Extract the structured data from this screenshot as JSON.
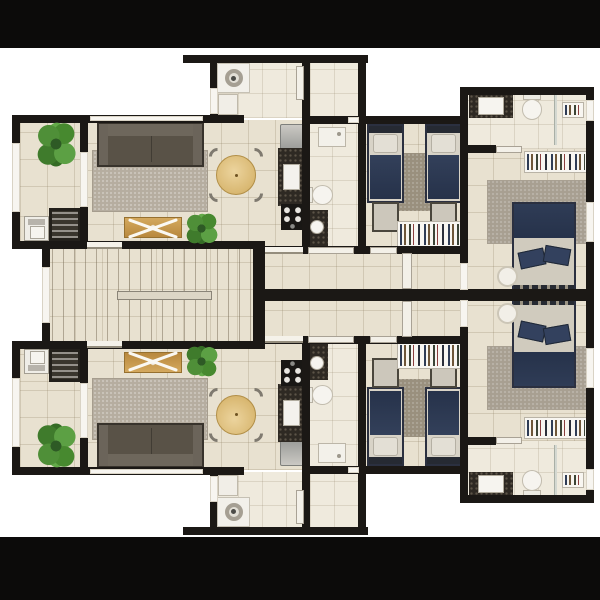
{
  "title": "apartment-floor-plan",
  "palette": {
    "background": "#ffffff",
    "letterbox": "#0c0b0a",
    "wall": "#1b1815",
    "floor_beige": "#e8e1d0",
    "floor_light": "#efeadd",
    "rug_gray": "#b6ada0",
    "sofa_gray": "#595247",
    "wood": "#c89a55",
    "table_wood": "#e0c084",
    "plant_green": "#4f8f38",
    "bed_navy": "#2c3950",
    "bedding_light": "#d8d3c7",
    "granite": "#2e2923",
    "fixture_white": "#f6f4ef"
  },
  "scene": {
    "canvas": {
      "w": 600,
      "h": 600
    },
    "mirror_axis_y": 295,
    "bars": [
      {
        "r": [
          0,
          0,
          600,
          48
        ]
      },
      {
        "r": [
          0,
          537,
          600,
          63
        ]
      }
    ],
    "floors": [
      {
        "r": [
          20,
          118,
          62,
          96
        ],
        "v": "b",
        "m": 1,
        "n": "balcony-floor"
      },
      {
        "r": [
          20,
          208,
          62,
          36
        ],
        "v": "b",
        "m": 1,
        "n": "laundry-floor"
      },
      {
        "r": [
          86,
          120,
          220,
          132
        ],
        "v": "b",
        "m": 1,
        "n": "living-dining-floor"
      },
      {
        "r": [
          214,
          60,
          152,
          58
        ],
        "v": "l",
        "m": 1,
        "n": "service-area-floor"
      },
      {
        "r": [
          308,
          121,
          52,
          132
        ],
        "v": "l",
        "m": 1,
        "n": "bathroom-floor"
      },
      {
        "r": [
          364,
          121,
          100,
          132
        ],
        "v": "b",
        "m": 1,
        "n": "twin-bedroom-floor"
      },
      {
        "r": [
          255,
          252,
          213,
          42
        ],
        "v": "b",
        "m": 1,
        "n": "corridor-floor"
      },
      {
        "r": [
          466,
          93,
          122,
          56
        ],
        "v": "l",
        "m": 1,
        "n": "ensuite-bathroom-floor"
      },
      {
        "r": [
          466,
          149,
          122,
          145
        ],
        "v": "b",
        "m": 1,
        "n": "master-bedroom-floor"
      },
      {
        "r": [
          48,
          246,
          207,
          98
        ],
        "v": "b",
        "m": 0,
        "n": "stair-hall-floor"
      }
    ],
    "walls": [
      {
        "r": [
          183,
          55,
          185,
          8
        ],
        "m": 1
      },
      {
        "r": [
          210,
          62,
          8,
          54
        ],
        "m": 1
      },
      {
        "r": [
          12,
          115,
          203,
          8
        ],
        "m": 1
      },
      {
        "r": [
          208,
          115,
          36,
          8
        ],
        "m": 1
      },
      {
        "r": [
          302,
          116,
          62,
          8
        ],
        "m": 1
      },
      {
        "r": [
          302,
          62,
          8,
          191
        ],
        "m": 1
      },
      {
        "r": [
          358,
          57,
          8,
          196
        ],
        "m": 1
      },
      {
        "r": [
          358,
          116,
          110,
          8
        ],
        "m": 1
      },
      {
        "r": [
          460,
          87,
          8,
          207
        ],
        "m": 1
      },
      {
        "r": [
          253,
          246,
          215,
          8
        ],
        "m": 1
      },
      {
        "r": [
          12,
          241,
          243,
          8
        ],
        "m": 1
      },
      {
        "r": [
          253,
          241,
          12,
          54
        ],
        "m": 1
      },
      {
        "r": [
          12,
          115,
          8,
          134
        ],
        "m": 1
      },
      {
        "r": [
          80,
          115,
          8,
          134
        ],
        "m": 1
      },
      {
        "r": [
          42,
          241,
          8,
          108
        ],
        "m": 0
      },
      {
        "r": [
          253,
          289,
          341,
          12
        ],
        "m": 0
      },
      {
        "r": [
          462,
          87,
          132,
          8
        ],
        "m": 1
      },
      {
        "r": [
          586,
          87,
          8,
          207
        ],
        "m": 1
      },
      {
        "r": [
          466,
          145,
          30,
          8
        ],
        "m": 1
      }
    ],
    "openings": [
      {
        "r": [
          90,
          116,
          113,
          5
        ],
        "v": "win",
        "m": 1,
        "n": "living-window"
      },
      {
        "r": [
          12,
          143,
          8,
          69
        ],
        "v": "win",
        "m": 1,
        "n": "balcony-window"
      },
      {
        "r": [
          42,
          267,
          8,
          56
        ],
        "v": "win",
        "m": 0,
        "n": "stair-hall-window"
      },
      {
        "r": [
          80,
          152,
          8,
          55
        ],
        "v": "win",
        "m": 1,
        "n": "balcony-door-opening"
      },
      {
        "r": [
          87,
          242,
          35,
          7
        ],
        "v": "sill",
        "m": 1,
        "n": "unit-entry-opening"
      },
      {
        "r": [
          265,
          247,
          38,
          7
        ],
        "v": "sill",
        "m": 1,
        "n": "corridor-opening"
      },
      {
        "r": [
          308,
          247,
          46,
          7
        ],
        "v": "door",
        "m": 1,
        "n": "bathroom-door"
      },
      {
        "r": [
          370,
          247,
          27,
          7
        ],
        "v": "door",
        "m": 1,
        "n": "twin-bedroom-door"
      },
      {
        "r": [
          460,
          263,
          8,
          27
        ],
        "v": "win",
        "m": 1,
        "n": "master-door-opening"
      },
      {
        "r": [
          402,
          253,
          10,
          36
        ],
        "v": "door",
        "m": 1,
        "n": "corridor-door-leaf"
      },
      {
        "r": [
          496,
          146,
          26,
          7
        ],
        "v": "door",
        "m": 1,
        "n": "ensuite-door"
      },
      {
        "r": [
          586,
          100,
          8,
          21
        ],
        "v": "win",
        "m": 1,
        "n": "ensuite-window"
      },
      {
        "r": [
          586,
          202,
          8,
          40
        ],
        "v": "win",
        "m": 1,
        "n": "master-window"
      },
      {
        "r": [
          296,
          66,
          8,
          34
        ],
        "v": "door",
        "m": 1,
        "n": "service-door-leaf"
      },
      {
        "r": [
          348,
          117,
          11,
          6
        ],
        "v": "win",
        "m": 1,
        "n": "bathroom-top-door"
      },
      {
        "r": [
          210,
          88,
          8,
          26
        ],
        "v": "win",
        "m": 1,
        "n": "service-window"
      }
    ],
    "items": [
      {
        "t": "rug",
        "r": [
          92,
          150,
          116,
          62
        ],
        "m": 1,
        "n": "living-rug"
      },
      {
        "t": "rug2",
        "r": [
          399,
          153,
          31,
          58
        ],
        "m": 1,
        "n": "twin-bedroom-rug"
      },
      {
        "t": "rug3",
        "r": [
          487,
          180,
          101,
          64
        ],
        "m": 1,
        "n": "master-rug"
      },
      {
        "t": "stairs",
        "r": [
          52,
          248,
          201,
          93
        ],
        "m": 0,
        "n": "staircase"
      },
      {
        "t": "sofa",
        "r": [
          97,
          122,
          107,
          45
        ],
        "m": 1,
        "n": "sofa"
      },
      {
        "t": "bench",
        "r": [
          124,
          217,
          58,
          21
        ],
        "m": 1,
        "n": "coffee-bench"
      },
      {
        "t": "dining",
        "r": [
          213,
          152,
          46,
          46
        ],
        "m": 1,
        "n": "dining-table-set"
      },
      {
        "t": "fridge",
        "r": [
          280,
          124,
          24,
          26
        ],
        "m": 1,
        "n": "refrigerator"
      },
      {
        "t": "counter",
        "r": [
          278,
          148,
          26,
          58
        ],
        "m": 1,
        "n": "kitchen-counter"
      },
      {
        "t": "sink-k",
        "r": [
          283,
          164,
          17,
          26
        ],
        "m": 1,
        "n": "kitchen-sink"
      },
      {
        "t": "stove",
        "r": [
          281,
          204,
          23,
          26
        ],
        "m": 1,
        "n": "stove"
      },
      {
        "t": "washer",
        "r": [
          24,
          216,
          25,
          25
        ],
        "m": 1,
        "n": "washing-machine"
      },
      {
        "t": "rack",
        "r": [
          49,
          208,
          32,
          33
        ],
        "m": 1,
        "n": "laundry-rack"
      },
      {
        "t": "ac",
        "r": [
          217,
          63,
          33,
          30
        ],
        "m": 1,
        "n": "ac-unit"
      },
      {
        "t": "cab",
        "r": [
          218,
          94,
          20,
          21
        ],
        "m": 1,
        "n": "service-cabinet"
      },
      {
        "t": "shower",
        "r": [
          318,
          127,
          28,
          20
        ],
        "m": 1,
        "n": "shower-tray"
      },
      {
        "t": "toilet-sm",
        "r": [
          306,
          185,
          27,
          20
        ],
        "m": 1,
        "n": "toilet"
      },
      {
        "t": "vanity-sm",
        "r": [
          306,
          210,
          22,
          39
        ],
        "m": 1,
        "n": "bathroom-vanity"
      },
      {
        "t": "twin-bed",
        "r": [
          367,
          124,
          37,
          79
        ],
        "m": 1,
        "n": "twin-bed"
      },
      {
        "t": "twin-bed",
        "r": [
          425,
          124,
          37,
          79
        ],
        "m": 1,
        "n": "twin-bed"
      },
      {
        "t": "ottoman",
        "r": [
          372,
          202,
          27,
          30
        ],
        "m": 1,
        "n": "bed-ottoman"
      },
      {
        "t": "ottoman",
        "r": [
          430,
          202,
          27,
          30
        ],
        "m": 1,
        "n": "bed-ottoman"
      },
      {
        "t": "shelf",
        "r": [
          397,
          221,
          65,
          27
        ],
        "m": 1,
        "n": "bookshelf"
      },
      {
        "t": "mb-vanity",
        "r": [
          469,
          94,
          44,
          24
        ],
        "m": 1,
        "n": "ensuite-vanity"
      },
      {
        "t": "mb-toilet",
        "r": [
          519,
          93,
          26,
          27
        ],
        "m": 1,
        "n": "ensuite-toilet"
      },
      {
        "t": "glass",
        "r": [
          554,
          95,
          3,
          50
        ],
        "m": 1,
        "n": "shower-glass"
      },
      {
        "t": "shelf",
        "r": [
          562,
          102,
          22,
          16
        ],
        "m": 1,
        "n": "shower-shelf"
      },
      {
        "t": "shelf",
        "r": [
          524,
          151,
          64,
          22
        ],
        "m": 1,
        "n": "wardrobe"
      },
      {
        "t": "db-bed",
        "r": [
          512,
          202,
          64,
          93
        ],
        "m": 1,
        "n": "double-bed"
      },
      {
        "t": "side",
        "r": [
          497,
          266,
          21,
          21
        ],
        "m": 1,
        "n": "bedside-table"
      },
      {
        "t": "plant",
        "r": [
          36,
          118,
          40,
          52
        ],
        "m": 1,
        "n": "plant"
      },
      {
        "t": "plant",
        "r": [
          184,
          211,
          35,
          35
        ],
        "m": 1,
        "n": "plant"
      }
    ]
  }
}
